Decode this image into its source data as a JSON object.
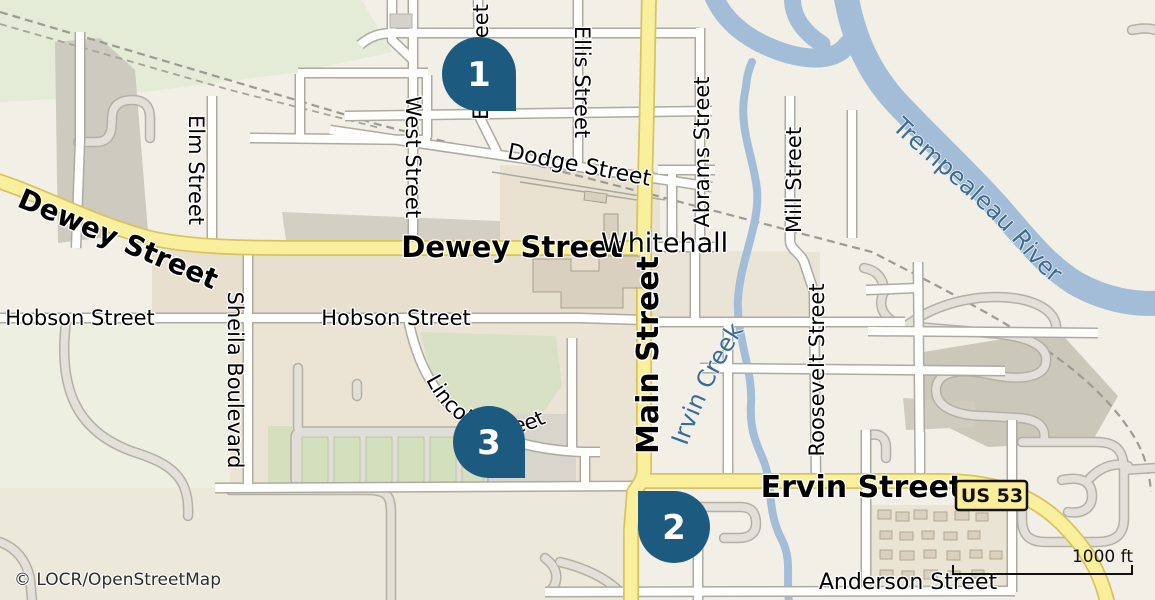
{
  "map": {
    "attribution": "© LOCR/OpenStreetMap",
    "scale": {
      "label": "1000 ft"
    },
    "place": {
      "label": "Whitehall"
    },
    "badge": {
      "label": "US 53"
    },
    "markers": [
      {
        "number": "1"
      },
      {
        "number": "2"
      },
      {
        "number": "3"
      }
    ],
    "streets": {
      "dewey_west": "Dewey Street",
      "dewey": "Dewey Street",
      "main": "Main Street",
      "ervin": "Ervin Street",
      "hobson_west": "Hobson Street",
      "hobson_east": "Hobson Street",
      "dodge": "Dodge Street",
      "elm": "Elm Street",
      "west": "West Street",
      "east": "East Street",
      "ellis": "Ellis Street",
      "abrams": "Abrams Street",
      "mill": "Mill Street",
      "roosevelt": "Roosevelt Street",
      "sheila": "Sheila Boulevard",
      "lincoln": "Lincoln Street",
      "anderson": "Anderson Street"
    },
    "waterways": {
      "river": "Trempealeau River",
      "creek": "Irvin Creek"
    },
    "colors": {
      "background": "#f2efe7",
      "water": "#a3bdd8",
      "primary_road": "#f9ef9d",
      "primary_road_casing": "#d9c35f",
      "minor_road": "#fefefc",
      "marker": "#1d5a80",
      "water_label": "#3c6b91",
      "park": "#d8e1c6"
    }
  }
}
